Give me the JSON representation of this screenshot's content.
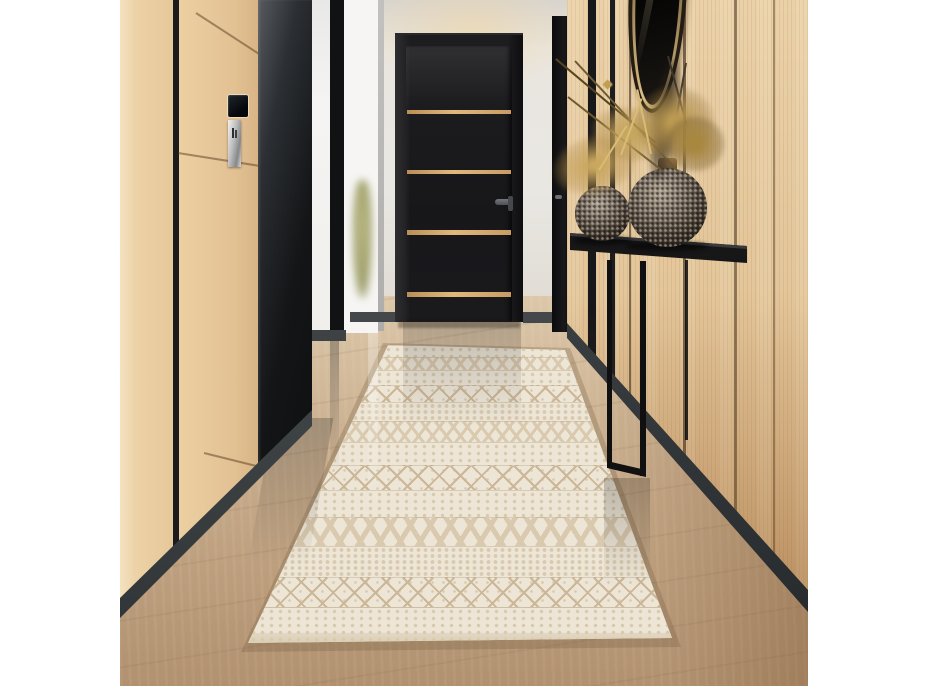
{
  "scene": {
    "type": "interior-photograph",
    "description": "Modern hallway with a cream geometric runner rug on glossy light-oak flooring, a black door with four gold inlay stripes at the end, light oak wood paneling with black trim on both walls, a slim black console table holding two textured bronze sphere vases with gold dried foliage, and an oval black-framed mirror above",
    "objects": {
      "left_wall": "Light oak paneled wall with black trim strips, wall keypad and chrome switch plate",
      "wall_keypad": "Small black wall-mounted control screen",
      "wall_plate": "Chrome switch plate with dark pictogram",
      "glossy_panel": "Tall dark glossy cabinet panel",
      "glass_partition": "Black-framed glass partition with plant visible through it",
      "door": "Black hallway door with four horizontal gold inlay stripes and dark lever handle",
      "side_door": "Partially visible black side door with small handle",
      "right_wall": "Light oak slatted wall with thin black trim seams",
      "mirror": "Oval black-framed wall mirror with gold inner rim",
      "console_table": "Slim black metal console table",
      "vase_small": "Small textured bronze sphere vase",
      "vase_large": "Large textured bronze sphere vase with narrow neck",
      "foliage": "Spray of gold dried foliage and dark twigs",
      "rug": "Cream hand-woven runner rug with banded geometric tribal pattern",
      "floor": "Glossy light oak plank floor with reflections",
      "back_wall": "Off-white wall with warm ceiling light glow"
    },
    "palette": {
      "border_white": "#ffffff",
      "wall_white": "#e9e7e2",
      "wood_light": "#ecd2a6",
      "wood_mid": "#e3c69a",
      "wood_floor": "#c7ab8a",
      "black_trim": "#1b1b1d",
      "door_black": "#17171a",
      "gold_inlay": "#e0b87c",
      "rug_base": "#ede6d7",
      "rug_tan": "#d9c9ae",
      "vase_bronze": "#6f655a",
      "foliage_gold": "#bf9e56",
      "table_black": "#121214"
    }
  },
  "rug": {
    "bands": [
      {
        "type": "dots",
        "h": 12
      },
      {
        "type": "zigzag",
        "h": 13
      },
      {
        "type": "dots",
        "h": 15
      },
      {
        "type": "lattice",
        "h": 17
      },
      {
        "type": "dotgrid",
        "h": 19
      },
      {
        "type": "zigzag",
        "h": 21
      },
      {
        "type": "dots",
        "h": 23
      },
      {
        "type": "lattice",
        "h": 25
      },
      {
        "type": "dots",
        "h": 27
      },
      {
        "type": "chevron",
        "h": 29
      },
      {
        "type": "dotgrid",
        "h": 31
      },
      {
        "type": "lattice",
        "h": 30
      },
      {
        "type": "edge",
        "h": 36
      }
    ]
  }
}
